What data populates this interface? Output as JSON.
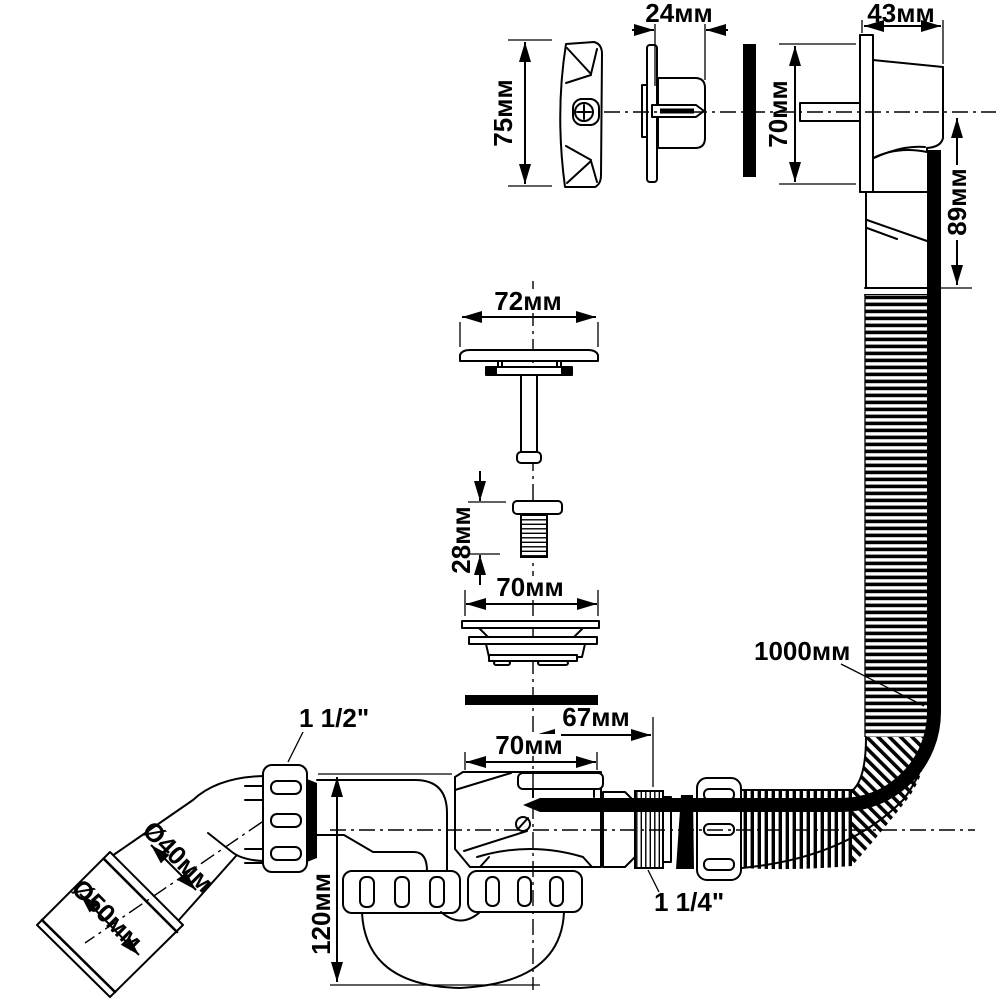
{
  "drawing": {
    "overflow": {
      "knob_height": "75мм",
      "flange_depth": "24мм",
      "body_width": "43мм",
      "body_height": "70мм",
      "tail_length": "89мм"
    },
    "drain": {
      "cover_width": "72мм",
      "screw_length": "28мм",
      "strainer_width": "70мм"
    },
    "siphon": {
      "flange_width": "70мм",
      "outlet_offset": "67мм",
      "trap_height": "120мм",
      "elbow_thread": "1 1/2\"",
      "union_thread": "1 1/4\"",
      "outlet_pipe_diameter": "Ø40мм",
      "outlet_sleeve_diameter": "Ø50мм"
    },
    "hose": {
      "length": "1000мм"
    },
    "colors": {
      "ink": "#000000",
      "paper": "#ffffff"
    }
  }
}
